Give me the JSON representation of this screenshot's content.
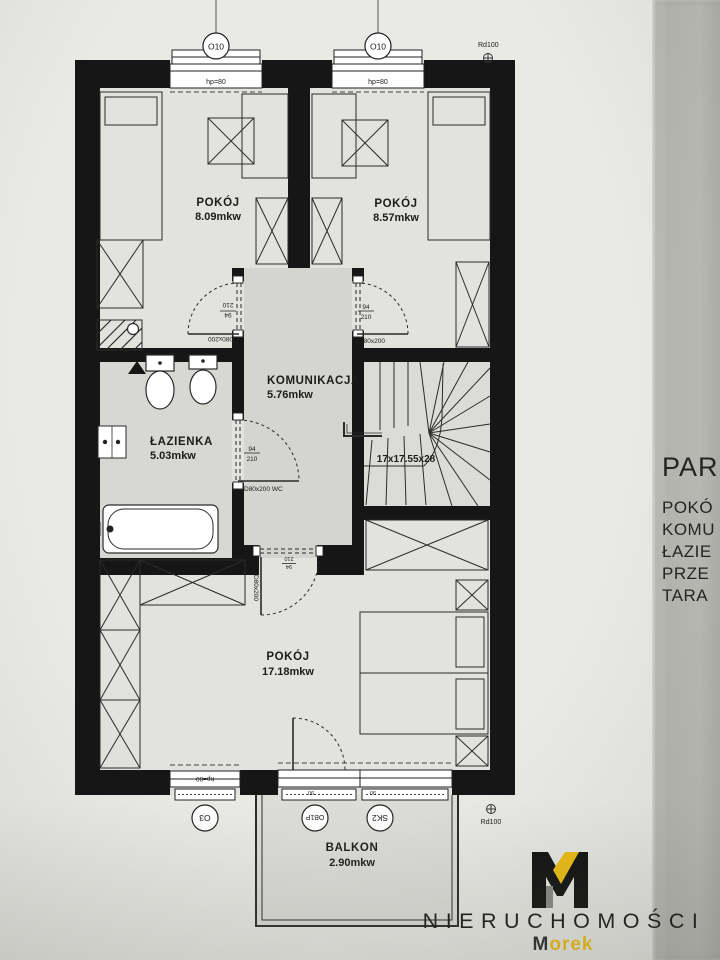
{
  "plan": {
    "rooms": [
      {
        "name": "POKÓJ",
        "area": "8.09mkw"
      },
      {
        "name": "POKÓJ",
        "area": "8.57mkw"
      },
      {
        "name": "KOMUNIKACJA",
        "area": "5.76mkw"
      },
      {
        "name": "ŁAZIENKA",
        "area": "5.03mkw"
      },
      {
        "name": "POKÓJ",
        "area": "17.18mkw"
      },
      {
        "name": "BALKON",
        "area": "2.90mkw"
      }
    ],
    "stairs_label": "17x17.55x28",
    "windows": {
      "o10": "O10",
      "hp80": "hp=80",
      "rd100": "Rd100",
      "o3": "O3",
      "ob1p": "OB1P",
      "sk2": "SK2",
      "size90": "90"
    },
    "doors": {
      "d80": "D80x200",
      "d80wc": "D80x200 WC",
      "w94": "94",
      "h210": "210"
    }
  },
  "side_panel": {
    "heading": "PAR",
    "items": [
      "POKÓ",
      "KOMU",
      "ŁAZIE",
      "PRZE",
      "TARA"
    ]
  },
  "logo": {
    "brand": "NIERUCHOMOŚCI",
    "name_prefix": "M",
    "name_suffix": "orek",
    "accent": "#efbf12"
  }
}
